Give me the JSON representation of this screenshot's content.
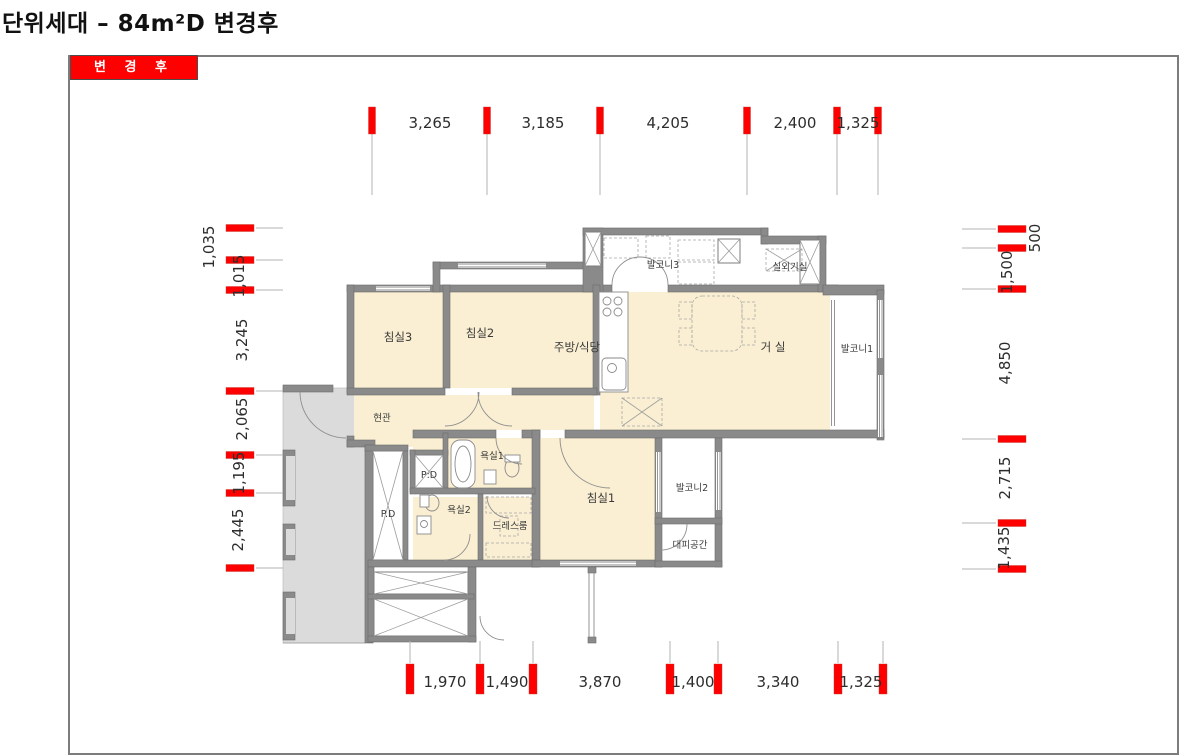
{
  "page": {
    "title": "단위세대 – 84m²D 변경후"
  },
  "panel": {
    "badge": "변 경 후"
  },
  "floor_plan": {
    "rooms": [
      {
        "name": "balcony-3",
        "label": "발코니3"
      },
      {
        "name": "outdoor-unit",
        "label": "실외기실"
      },
      {
        "name": "bedroom-3",
        "label": "침실3"
      },
      {
        "name": "bedroom-2",
        "label": "침실2"
      },
      {
        "name": "kitchen-dining",
        "label": "주방/식당"
      },
      {
        "name": "living-room",
        "label": "거 실"
      },
      {
        "name": "balcony-1",
        "label": "발코니1"
      },
      {
        "name": "entrance",
        "label": "현관"
      },
      {
        "name": "pipe-duct-upper",
        "label": "P:D"
      },
      {
        "name": "bathroom-1",
        "label": "욕실1"
      },
      {
        "name": "pipe-duct-left",
        "label": "P.D"
      },
      {
        "name": "bathroom-2",
        "label": "욕실2"
      },
      {
        "name": "dress-room",
        "label": "드레스룸"
      },
      {
        "name": "bedroom-1",
        "label": "침실1"
      },
      {
        "name": "balcony-2",
        "label": "발코니2"
      },
      {
        "name": "refuge-space",
        "label": "대피공간"
      }
    ],
    "dimensions": {
      "top": [
        "3,265",
        "3,185",
        "4,205",
        "2,400",
        "1,325"
      ],
      "bottom": [
        "1,970",
        "1,490",
        "3,870",
        "1,400",
        "3,340",
        "1,325"
      ],
      "left": [
        "1,035",
        "1,015",
        "3,245",
        "2,065",
        "1,195",
        "2,445"
      ],
      "right": [
        "500",
        "1,500",
        "4,850",
        "2,715",
        "1,435"
      ]
    },
    "colors": {
      "accent_red": "#ff0000",
      "room_fill": "#faefd2",
      "wall_gray": "#8a8a8a",
      "common_area_gray": "#dbdbdb"
    }
  }
}
